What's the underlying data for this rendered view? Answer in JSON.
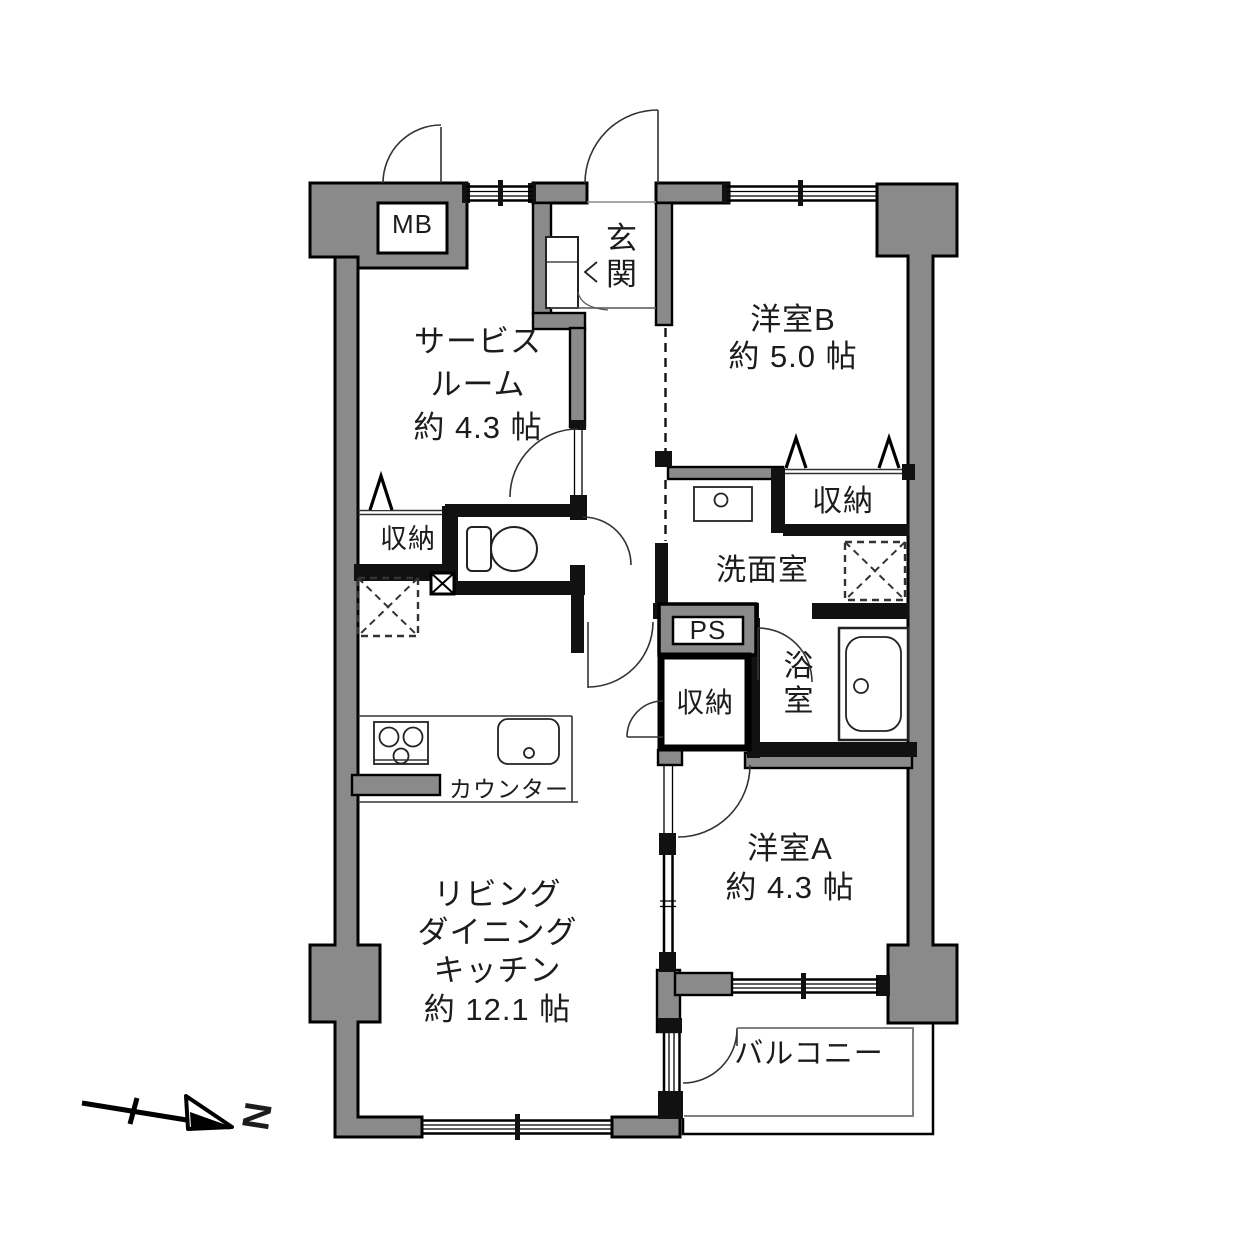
{
  "colors": {
    "wall_fill": "#8a8a8a",
    "line": "#000000",
    "background": "#ffffff"
  },
  "floorplan": {
    "compass_label": "N",
    "rooms": {
      "entrance": {
        "label": "玄関"
      },
      "western_room_b": {
        "label": "洋室B",
        "area": "約 5.0 帖"
      },
      "service_room": {
        "label_line1": "サービス",
        "label_line2": "ルーム",
        "area": "約 4.3 帖"
      },
      "washroom": {
        "label": "洗面室"
      },
      "bathroom": {
        "label": "浴室"
      },
      "western_room_a": {
        "label": "洋室A",
        "area": "約 4.3 帖"
      },
      "ldk": {
        "label_line1": "リビング",
        "label_line2": "ダイニング",
        "label_line3": "キッチン",
        "area": "約 12.1 帖"
      },
      "balcony": {
        "label": "バルコニー"
      }
    },
    "storage": {
      "service_room_closet": {
        "label": "収納"
      },
      "western_room_b_closet": {
        "label": "収納"
      },
      "hallway_closet": {
        "label": "収納"
      }
    },
    "utilities": {
      "meter_box": {
        "label": "MB"
      },
      "pipe_space": {
        "label": "PS"
      }
    },
    "kitchen": {
      "counter_label": "カウンター"
    }
  }
}
